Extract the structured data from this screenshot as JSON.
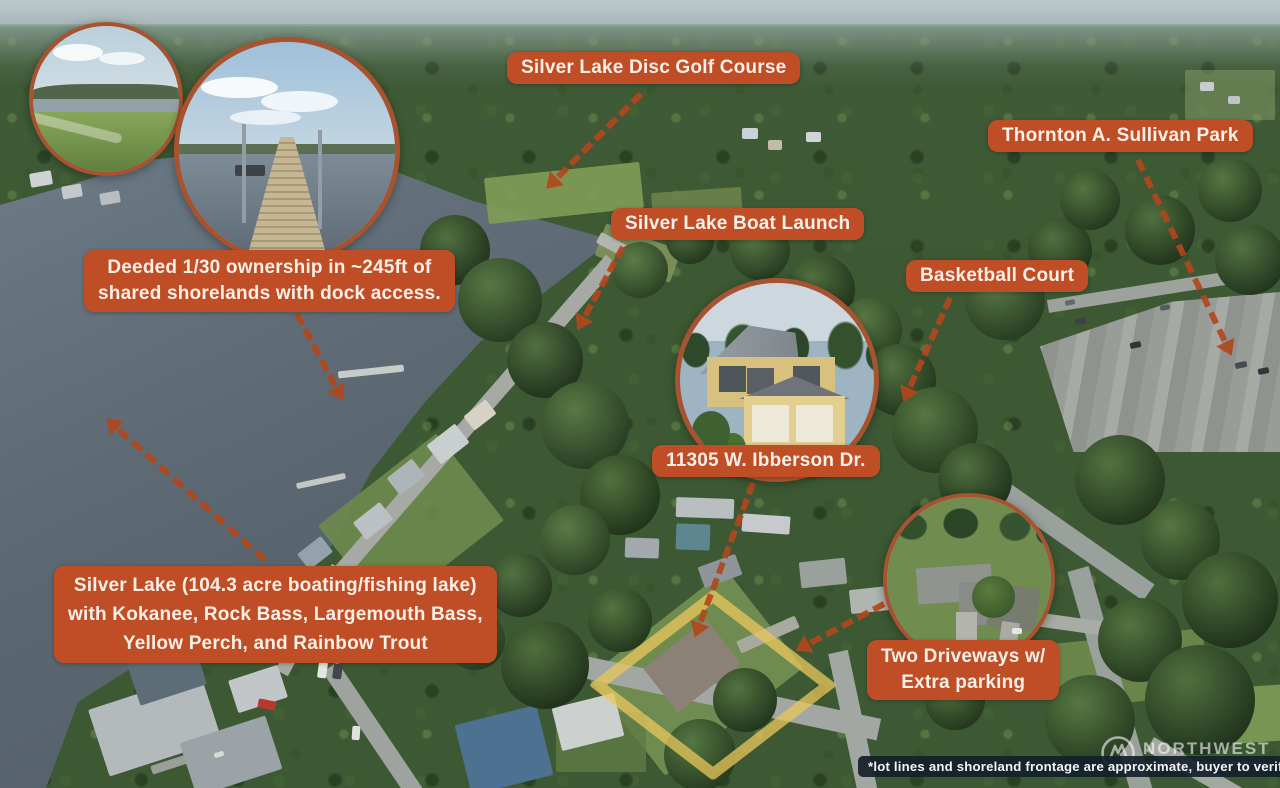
{
  "annotations": {
    "disc_golf": "Silver Lake Disc Golf Course",
    "thornton_park": "Thornton A. Sullivan Park",
    "boat_launch": "Silver Lake Boat Launch",
    "basketball_court": "Basketball Court",
    "deeded_line1": "Deeded 1/30 ownership in ~245ft of",
    "deeded_line2": "shared shorelands with dock access.",
    "address": "11305 W. Ibberson Dr.",
    "lake_line1": "Silver Lake (104.3 acre boating/fishing lake)",
    "lake_line2": "with Kokanee, Rock Bass, Largemouth Bass,",
    "lake_line3": "Yellow Perch, and Rainbow Trout",
    "driveways_line1": "Two Driveways w/",
    "driveways_line2": "Extra parking"
  },
  "disclaimer": "*lot lines and shoreland frontage are approximate, buyer to verify",
  "watermark": {
    "brand": "NORTHWEST"
  },
  "insets": {
    "shorelands_icon": "shared-shoreland-photo",
    "dock_icon": "community-dock-photo",
    "house_icon": "subject-house-photo",
    "driveways_icon": "aerial-driveways-photo"
  },
  "colors": {
    "label_bg": "#bf4e26",
    "label_text": "#f8efe7",
    "arrow": "#b2461c",
    "lot_outline": "#e9c75c",
    "disclaimer_bg": "#141f2b",
    "disclaimer_text": "#f2f4f6"
  }
}
